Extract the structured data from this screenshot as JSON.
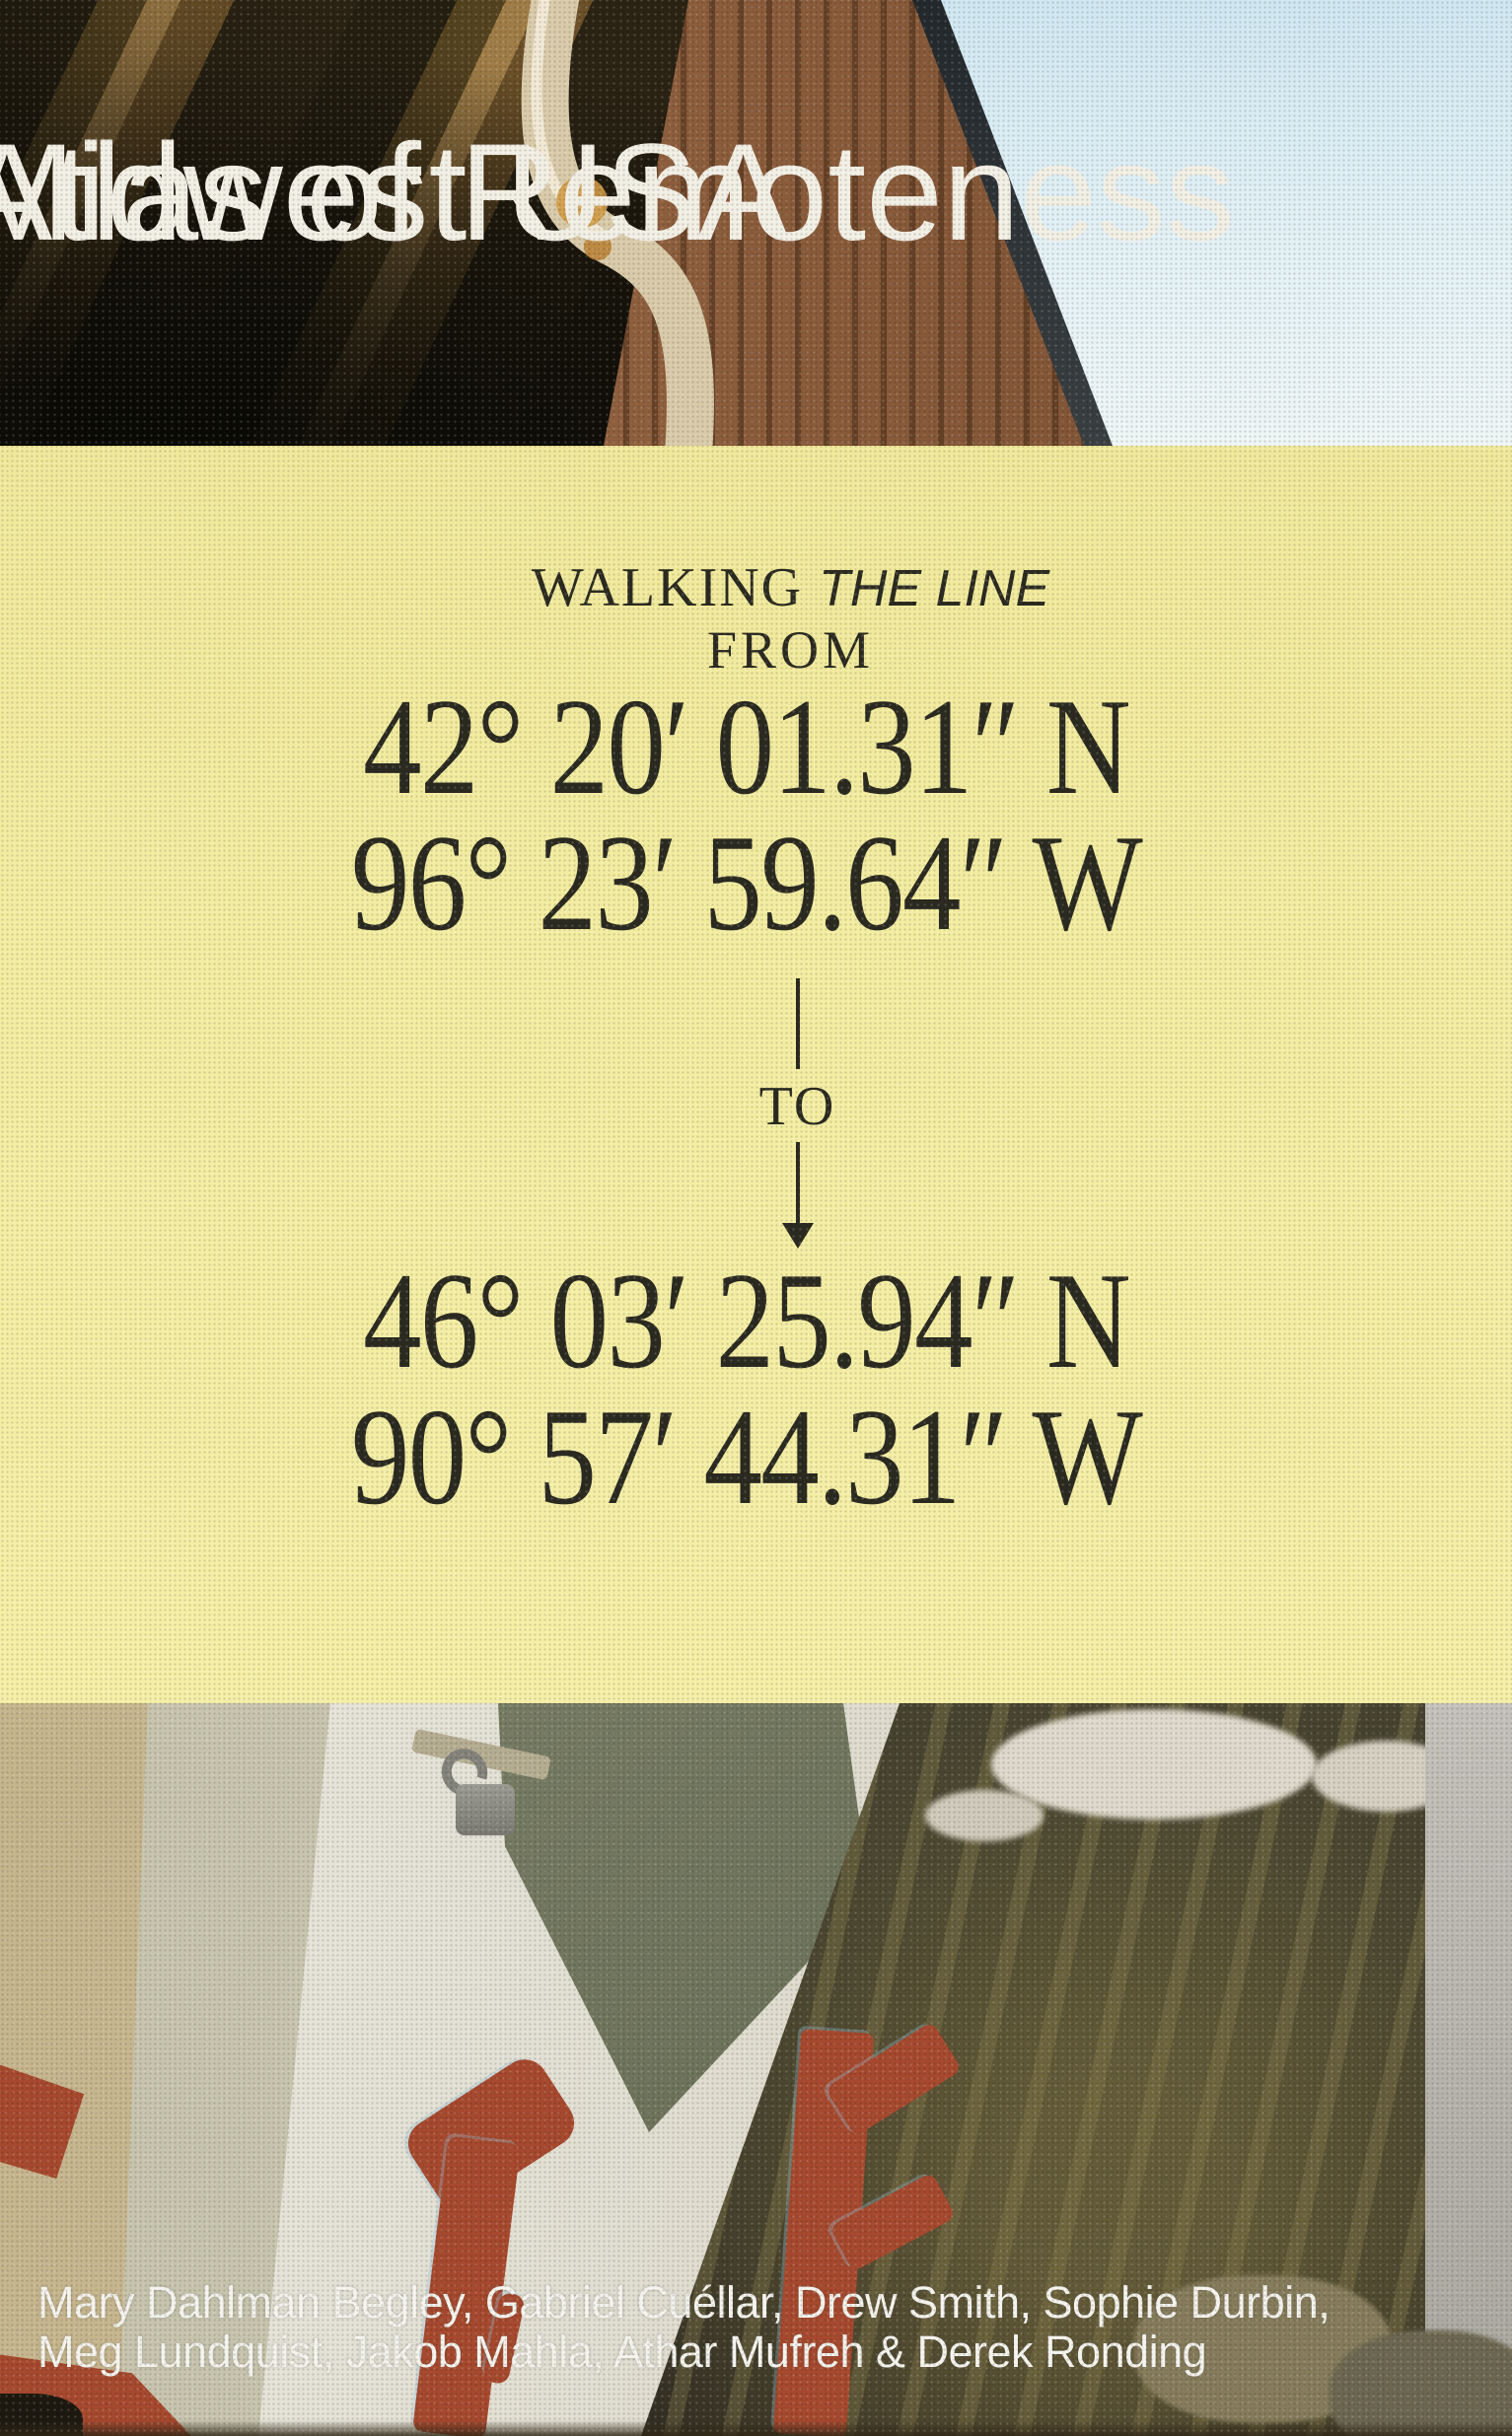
{
  "cover": {
    "title": {
      "line1": "Atlas of Remoteness",
      "line2": "Midwest USA"
    },
    "panel": {
      "walking_label": "WALKING",
      "line_label": "THE LINE",
      "from_label": "FROM",
      "to_label": "TO",
      "origin": {
        "latitude": "42° 20′ 01.31″ N",
        "longitude": "96° 23′ 59.64″ W"
      },
      "destination": {
        "latitude": "46° 03′ 25.94″ N",
        "longitude": "90° 57′ 44.31″ W"
      }
    },
    "authors": {
      "line1": "Mary Dahlman Begley, Gabriel Cuéllar, Drew Smith, Sophie Durbin,",
      "line2": "Meg Lundquist, Jakob Mahla, Athar Mufreh & Derek Ronding"
    },
    "colors": {
      "panel_yellow": "#f2eca1",
      "ink_dark": "#2b2a21",
      "title_white": "#f2efe5",
      "painted_letter_red": "#a6492e",
      "sky_blue": "#d9ecf4"
    }
  }
}
